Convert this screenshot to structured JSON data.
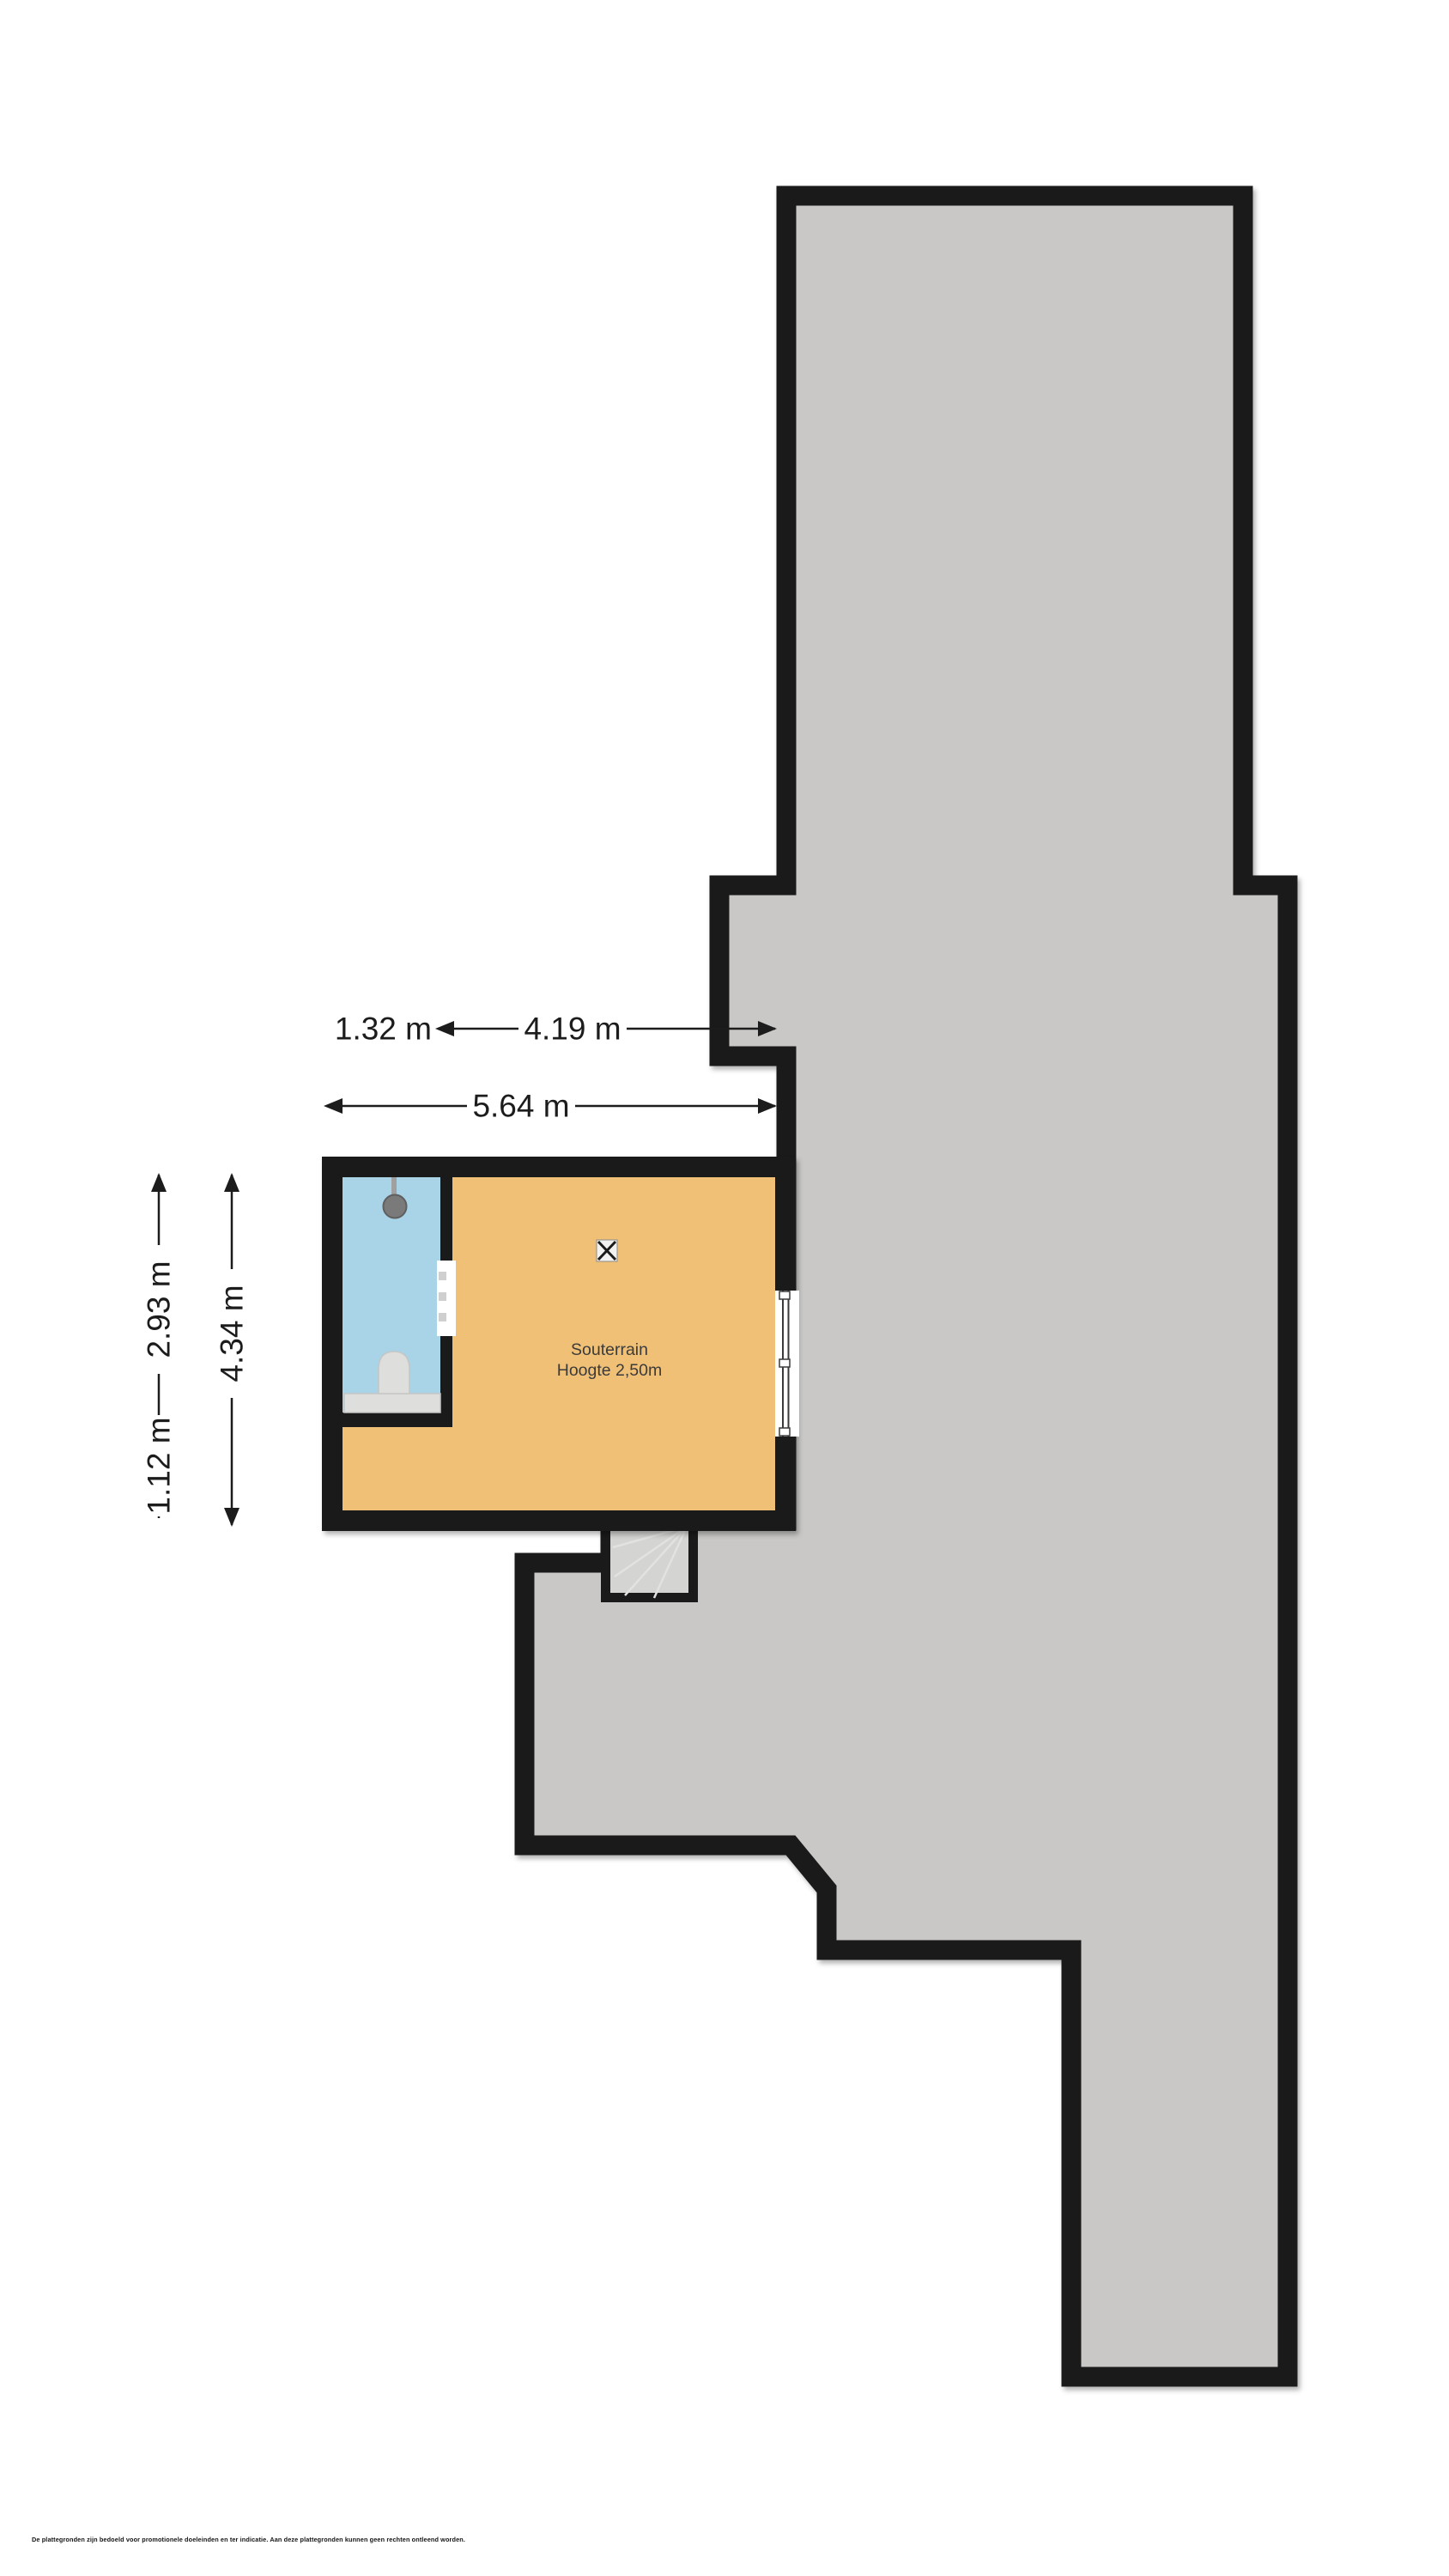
{
  "floorplan": {
    "room": {
      "name": "Souterrain",
      "height_note": "Hoogte 2,50m"
    },
    "dimensions": {
      "bathroom_width": "1.32 m",
      "room_width_inner": "4.19 m",
      "total_width": "5.64 m",
      "bathroom_height": "2.93 m",
      "below_bathroom_height": "1.12 m",
      "total_height": "4.34 m"
    },
    "disclaimer": "De plattegronden zijn bedoeld voor promotionele doeleinden en ter indicatie. Aan deze plattegronden kunnen geen rechten ontleend worden.",
    "colors": {
      "wall": "#1a1a1a",
      "footprint": "#c9c8c6",
      "room": "#f0c077",
      "bathroom": "#a9d3e6",
      "stairs": "#d4d4d2",
      "stair-lines": "#e2e2e0",
      "fixture": "#dededd",
      "fixture-dark": "#7a7a7a",
      "dim-text": "#1c1c1c",
      "label-text": "#3b3b3b"
    }
  }
}
